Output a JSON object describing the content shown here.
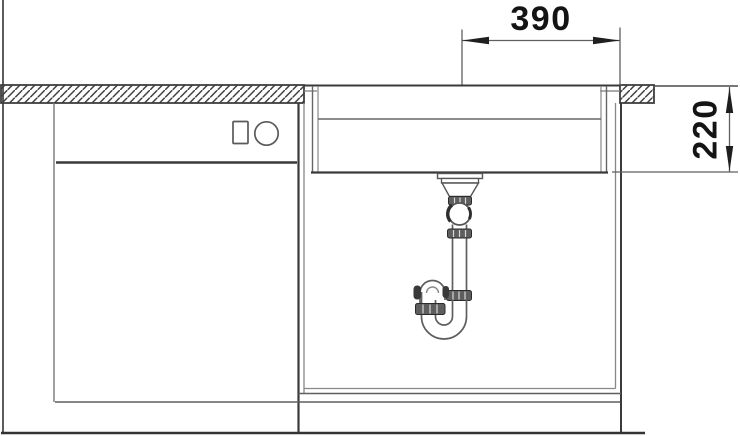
{
  "drawing": {
    "dimensions": {
      "top_width": "390",
      "right_depth": "220"
    },
    "colors": {
      "background": "#ffffff",
      "line_dark": "#3a3a3a",
      "line_mid": "#5f5f5f",
      "line_light": "#888888",
      "dimension_line": "#5f5f5f",
      "arrow": "#1f1f1f",
      "text": "#141414"
    }
  }
}
